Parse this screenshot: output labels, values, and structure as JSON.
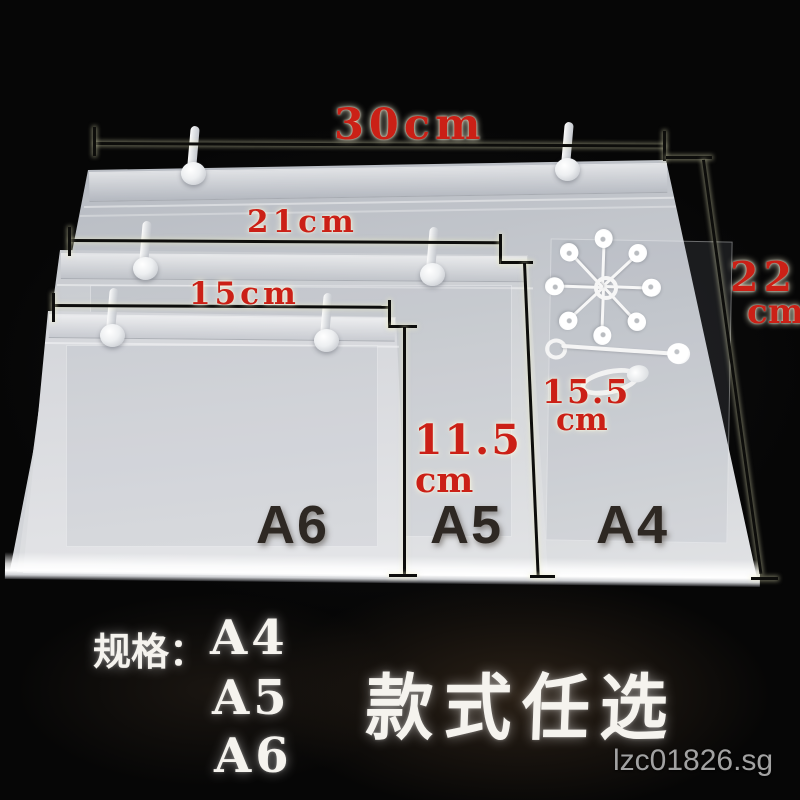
{
  "photo": {
    "measurements": {
      "a4_width": "30cm",
      "a5_width": "21cm",
      "a6_width": "15cm",
      "a4_height_value": "22",
      "a4_height_unit": "cm",
      "a6_height_value": "11.5",
      "a6_height_unit": "cm",
      "a5_height_value": "15.5",
      "a5_height_unit": "cm"
    },
    "sheet_labels": {
      "a6": "A6",
      "a5": "A5",
      "a4": "A4"
    },
    "caption": {
      "spec_label": "规格：",
      "sizes": [
        "A4",
        "A5",
        "A6"
      ],
      "slogan": "款式任选"
    },
    "watermark": "lzc01826.sg",
    "colors": {
      "background": "#060606",
      "dimension_text": "#cb2016",
      "label_text": "#2e2823",
      "caption_text": "#f5f3ee",
      "watermark_text": "#a2a2a2"
    }
  }
}
